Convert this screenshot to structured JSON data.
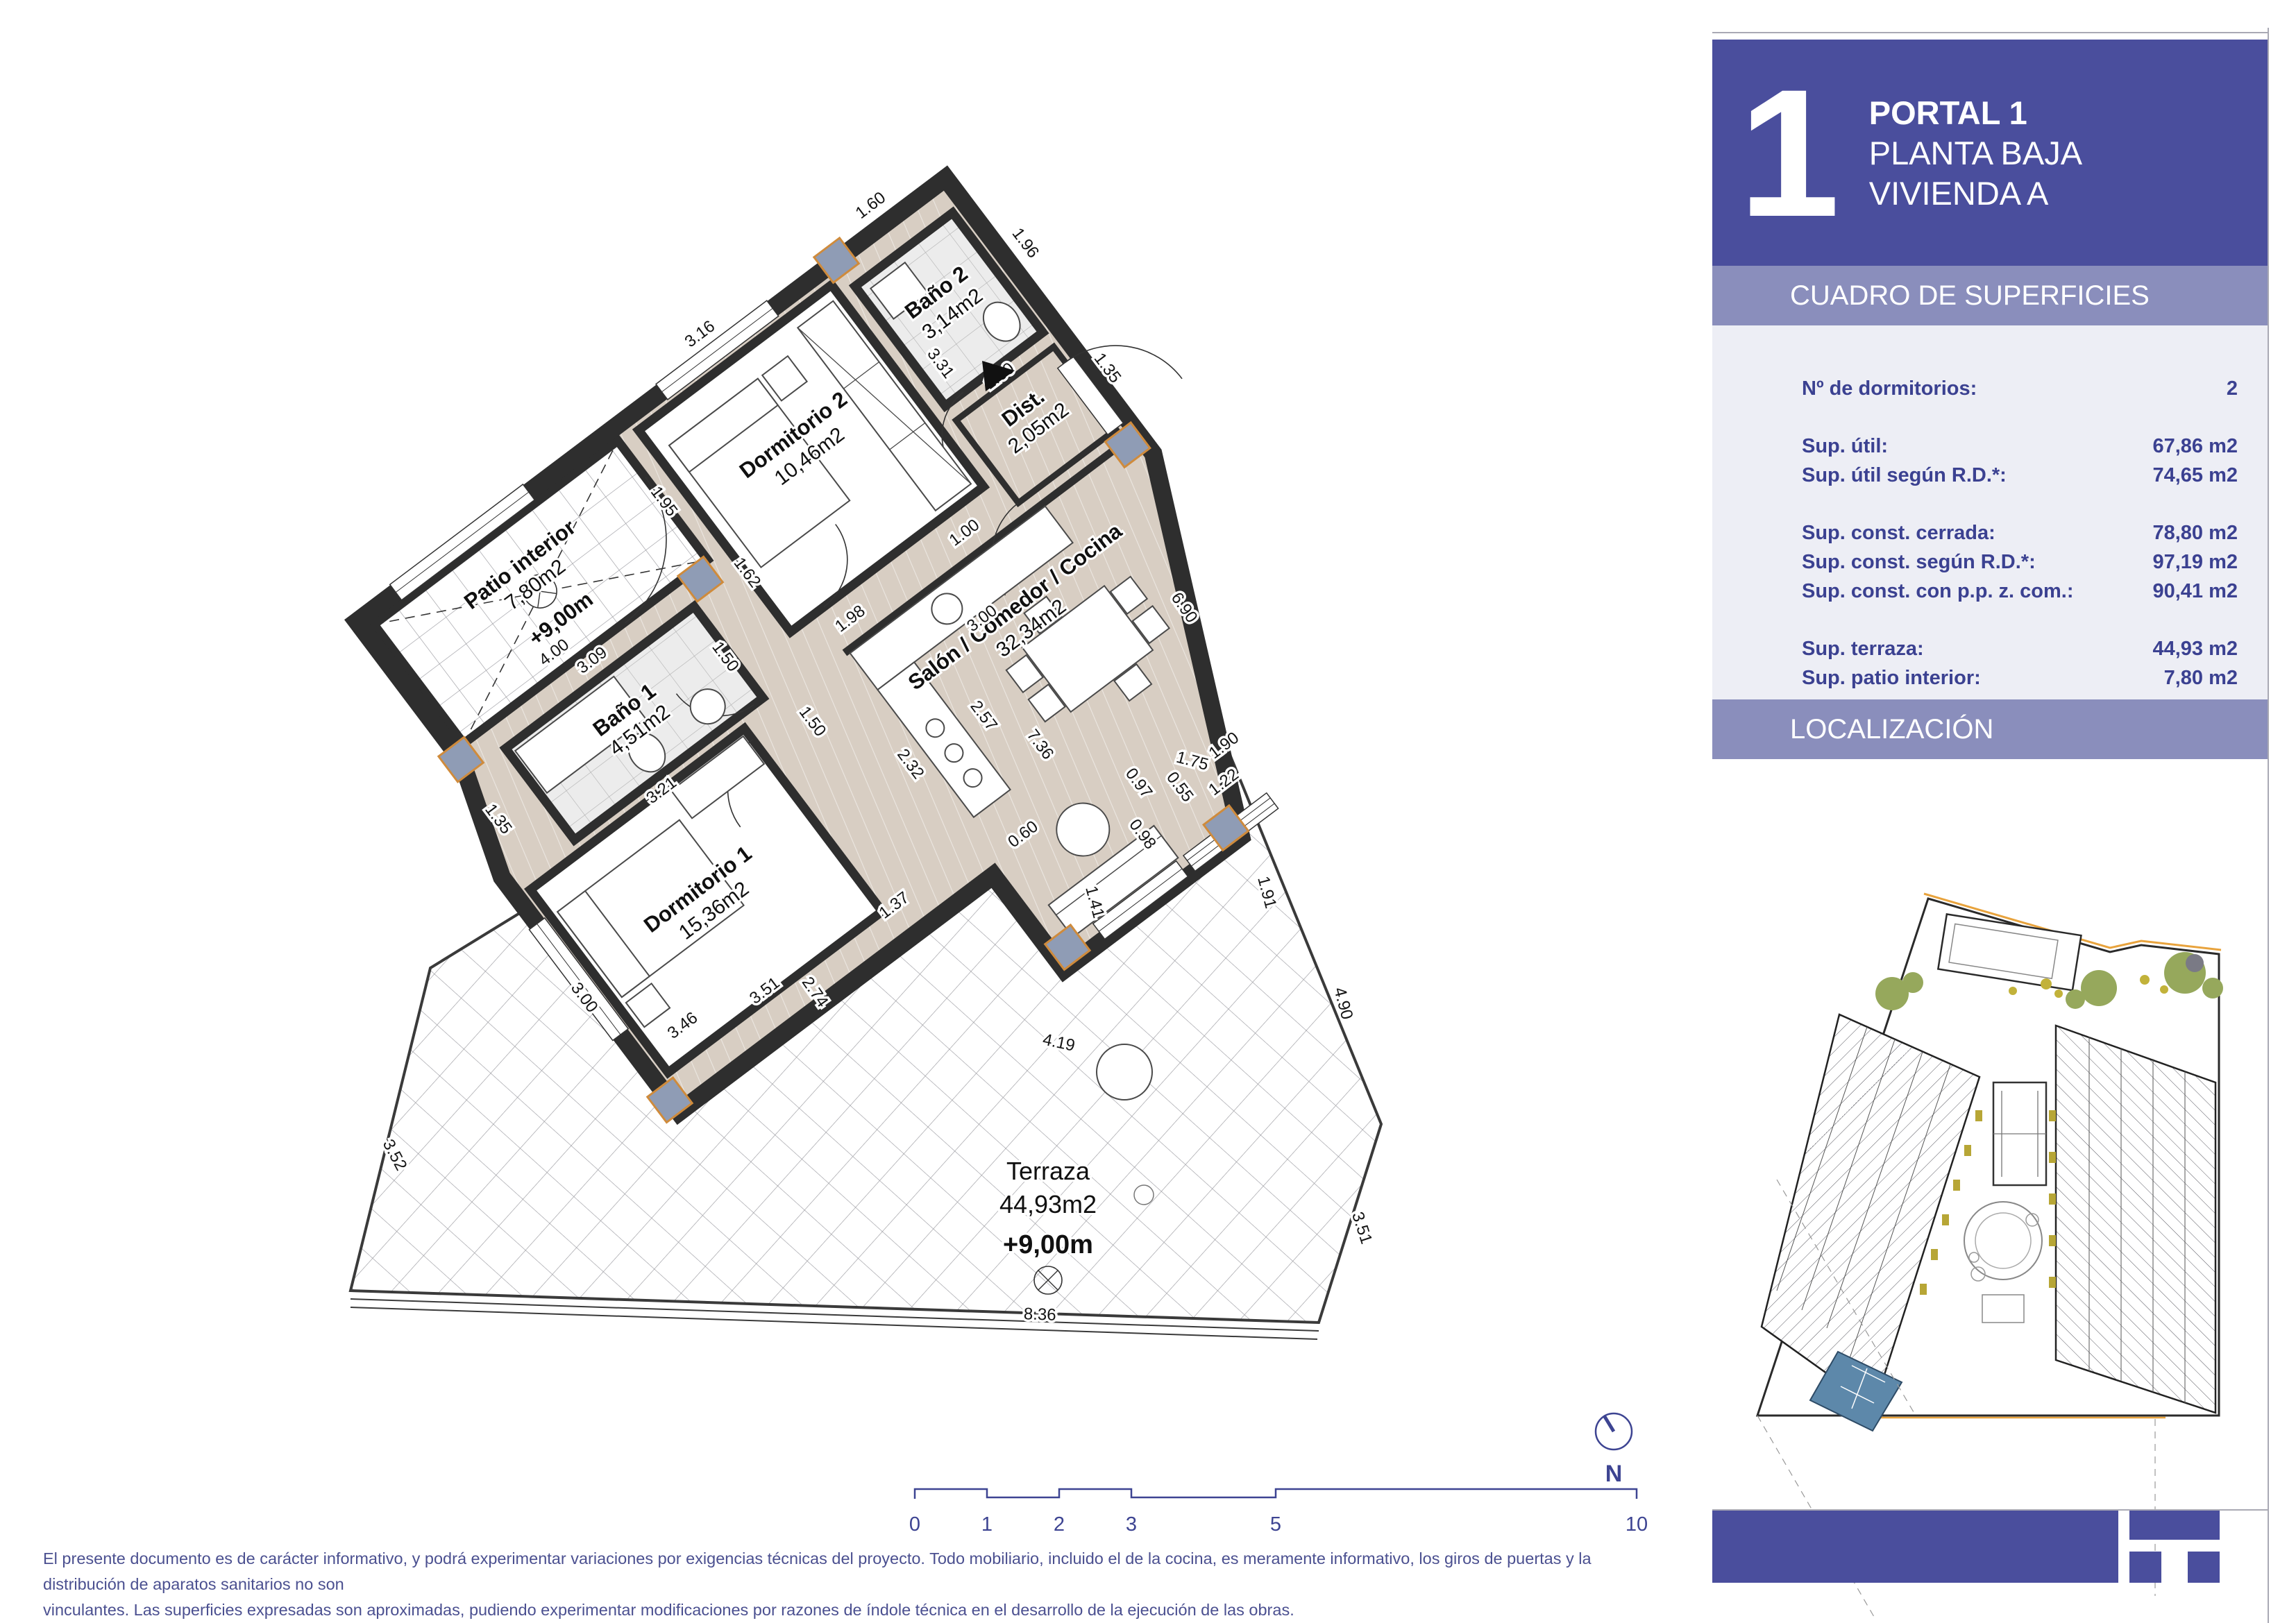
{
  "header": {
    "portal_number": "1",
    "line1": "PORTAL 1",
    "line2": "PLANTA BAJA",
    "line3": "VIVIENDA A"
  },
  "surfaces": {
    "title": "CUADRO DE SUPERFICIES",
    "rows": [
      {
        "label": "Nº de dormitorios:",
        "value": "2"
      },
      {
        "label": "Sup. útil:",
        "value": "67,86 m2"
      },
      {
        "label": "Sup. útil según R.D.*:",
        "value": "74,65 m2"
      },
      {
        "label": "Sup. const. cerrada:",
        "value": "78,80 m2"
      },
      {
        "label": "Sup. const. según R.D.*:",
        "value": "97,19 m2"
      },
      {
        "label": "Sup. const. con p.p. z. com.:",
        "value": "90,41 m2"
      },
      {
        "label": "Sup. terraza:",
        "value": "44,93 m2"
      },
      {
        "label": "Sup. patio interior:",
        "value": "7,80 m2"
      }
    ]
  },
  "localization": {
    "title": "LOCALIZACIÓN"
  },
  "plan": {
    "rooms": [
      {
        "name": "Dormitorio 2",
        "area": "10,46m2"
      },
      {
        "name": "Baño 2",
        "area": "3,14m2"
      },
      {
        "name": "Dist.",
        "area": "2,05m2"
      },
      {
        "name": "Patio interior",
        "area": "7,80m2",
        "level": "+9,00m"
      },
      {
        "name": "Baño 1",
        "area": "4,51m2"
      },
      {
        "name": "Dormitorio 1",
        "area": "15,36m2"
      },
      {
        "name": "Salón / Comedor / Cocina",
        "area": "32,34m2"
      },
      {
        "name": "Terraza",
        "area": "44,93m2",
        "level": "+9,00m"
      }
    ],
    "dims": [
      "3.16",
      "1.60",
      "1.96",
      "3.31",
      "1.60",
      "1.35",
      "1.00",
      "1.98",
      "3.00",
      "1.50",
      "2.32",
      "2.57",
      "0.60",
      "1.37",
      "7.36",
      "1.90",
      "3.09",
      "1.50",
      "1.95",
      "4.00",
      "3.21",
      "3.00",
      "3.51",
      "1.35",
      "0.97",
      "0.55",
      "1.22",
      "0.98",
      "1.62",
      "6.90",
      "1.75",
      "1.91",
      "1.41",
      "4.90",
      "3.51",
      "8.36",
      "3.52",
      "3.46",
      "2.74",
      "4.19"
    ],
    "north_label": "N"
  },
  "scalebar": {
    "labels": [
      "0",
      "1",
      "2",
      "3",
      "5",
      "10"
    ]
  },
  "footer": {
    "line1": "El presente documento es de carácter informativo, y podrá experimentar variaciones por exigencias técnicas del proyecto. Todo mobiliario, incluido el de la cocina, es meramente informativo, los giros de puertas y la distribución de aparatos sanitarios no son",
    "line2": "vinculantes. Las superficies expresadas son aproximadas, pudiendo experimentar modificaciones por razones de índole técnica en el desarrollo de la ejecución de las obras."
  },
  "colors": {
    "accent": "#4a4e9d",
    "bar": "#8a8ebc",
    "panel": "#edeef5",
    "navy_text": "#3b4191",
    "wall": "#2e2e2e",
    "floor": "#d8cec3",
    "unit_highlight": "#5d88aa"
  }
}
